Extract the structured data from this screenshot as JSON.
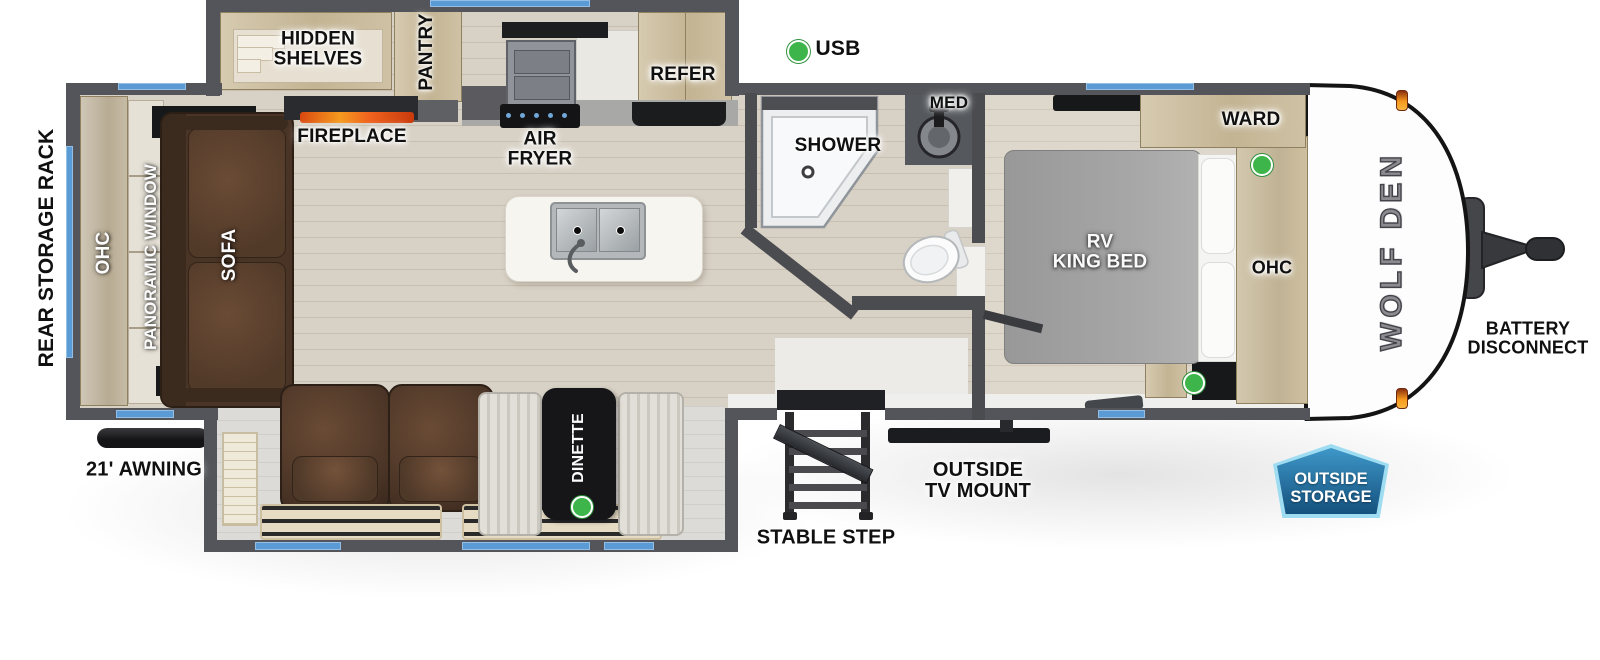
{
  "title": "Wolf Den travel trailer floorplan",
  "brand": {
    "logo_text": "WOLF DEN"
  },
  "legend": {
    "usb_label": "USB"
  },
  "labels": {
    "rear_storage_rack": "REAR STORAGE RACK",
    "ohc_rear": "OHC",
    "panoramic_window": "PANORAMIC WINDOW",
    "sofa": "SOFA",
    "hidden_shelves": "HIDDEN\nSHELVES",
    "fireplace": "FIREPLACE",
    "pantry": "PANTRY",
    "air_fryer": "AIR\nFRYER",
    "refer": "REFER",
    "shower": "SHOWER",
    "med": "MED",
    "ward": "WARD",
    "rv_king_bed": "RV\nKING BED",
    "ohc_bedroom": "OHC",
    "dinette": "DINETTE",
    "awning": "21' AWNING",
    "stable_step": "STABLE STEP",
    "outside_tv_mount": "OUTSIDE\nTV MOUNT",
    "battery_disconnect": "BATTERY\nDISCONNECT",
    "outside_storage": "OUTSIDE\nSTORAGE"
  },
  "colors": {
    "wall": "#54555a",
    "window_accent": "#5b9bd5",
    "usb_dot": "#3db54a",
    "flame": "#f0641e",
    "badge_fill": "#2a7ab5",
    "badge_border": "#9edcf2",
    "sofa_brown": "#4a3426",
    "cabinet_wood": "#c9bda3"
  }
}
